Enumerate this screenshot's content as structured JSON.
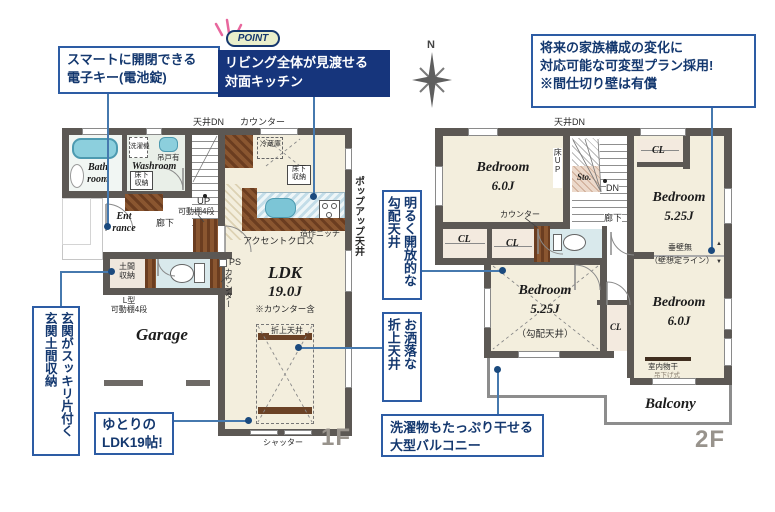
{
  "callouts": {
    "smart_key": "スマートに開閉できる\n電子キー(電池錠)",
    "point_badge": "POINT",
    "point_text": "リビング全体が見渡せる\n対面キッチン",
    "flexible_plan": "将来の家族構成の変化に\n対応可能な可変型プラン採用!\n※間仕切り壁は有償",
    "genkan_storage": "玄関がスッキリ片付く\n玄関土間収納",
    "roomy_ldk": "ゆとりの\nLDK19帖!",
    "sloped_ceiling": "明るく開放的な\n勾配天井",
    "coffered_ceiling": "お洒落な\n折上天井",
    "big_balcony": "洗濯物もたっぷり干せる\n大型バルコニー"
  },
  "compass": {
    "north": "N"
  },
  "floor1": {
    "label": "1F",
    "ceiling_dn": "天井DN",
    "counter": "カウンター",
    "bathroom": "Bath\nroom",
    "washroom": "Washroom",
    "washer": "洗濯機",
    "hanging_cupboard": "吊戸有",
    "underfloor_storage": "床下\n収納",
    "up": "UP",
    "movable_shelf": "可動棚4段",
    "entrance": "Ent\nrance",
    "hallway": "廊下",
    "doma_storage": "土間\n収納",
    "l_shelf": "L型\n可動棚4段",
    "ps": "PS",
    "counter_vertical": "カウンター",
    "fridge": "冷蔵庫",
    "niche": "造作ニッチ",
    "accent_cross": "アクセントクロス",
    "popup_ceiling": "ポップアップ天井",
    "ldk": "LDK",
    "ldk_size": "19.0J",
    "ldk_note": "※カウンター含",
    "coffered": "折上天井",
    "garage": "Garage",
    "shutter": "シャッター"
  },
  "floor2": {
    "label": "2F",
    "ceiling_dn": "天井DN",
    "bedroom": "Bedroom",
    "size_6": "6.0J",
    "size_525": "5.25J",
    "floor_up": "床UP",
    "storage": "Sto.",
    "dn": "DN",
    "closet": "CL",
    "no_hanging_wall": "垂壁無",
    "assumed_wall": "（壁想定ライン）",
    "arrow_up": "▲",
    "arrow_down": "▼",
    "hallway": "廊下",
    "counter": "カウンター",
    "sloped_note": "（勾配天井）",
    "indoor_drying": "室内物干",
    "hanging_type": "吊下げ式",
    "balcony": "Balcony"
  }
}
